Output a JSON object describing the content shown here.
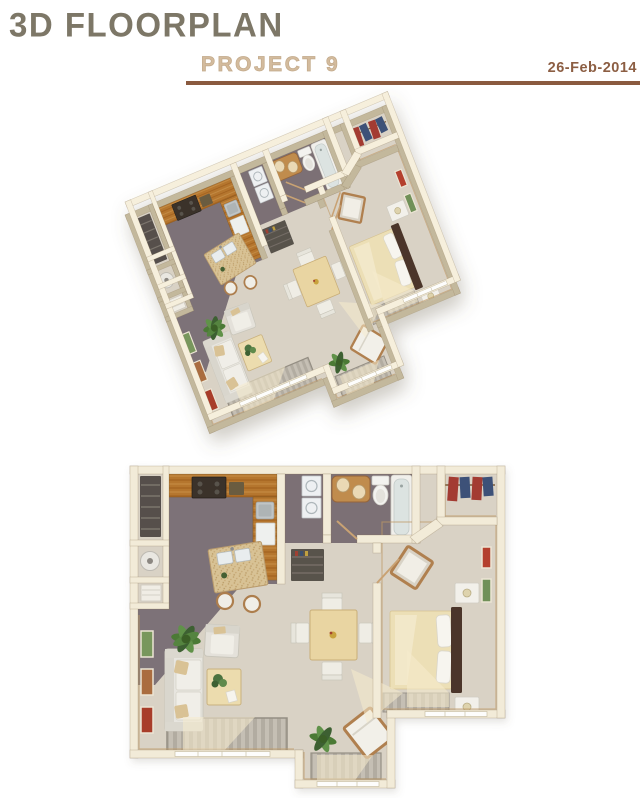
{
  "header": {
    "title": "3D FLOORPLAN",
    "subtitle": "PROJECT 9",
    "date": "26-Feb-2014"
  },
  "views": [
    {
      "id": "perspective",
      "label": "3D perspective render of one-bedroom apartment"
    },
    {
      "id": "top-down",
      "label": "Top-down render of the same one-bedroom apartment"
    }
  ],
  "apartment": {
    "rooms": [
      "kitchen",
      "entry-hall",
      "utility-closet",
      "laundry-nook",
      "bathroom",
      "walk-in-closet",
      "bedroom",
      "dining-area",
      "living-room",
      "balcony-nook"
    ],
    "furniture": [
      "l-shaped-wood-counter",
      "stove",
      "kitchen-island-with-sink",
      "bar-stools",
      "washer-dryer-stack",
      "water-heater",
      "wire-shelving",
      "wood-vanity",
      "toilet",
      "bathtub",
      "hanging-clothes",
      "bed",
      "headboard",
      "nightstands",
      "desk-chair",
      "dining-table",
      "dining-chairs",
      "sofa",
      "armchair",
      "coffee-table",
      "lounge-chair",
      "potted-plants",
      "area-rugs",
      "framed-pictures"
    ]
  },
  "palette": {
    "title_text": "#7d7767",
    "subtitle_text": "#d3bb9d",
    "date_text": "#8c5e43",
    "rule": "#8a5a3f",
    "wall": "#f2ebd8",
    "wall_top": "#f6efdc",
    "wall_shadow": "#c3b89c",
    "floor_light": "#d9d2c5",
    "floor_gray": "#7d7278",
    "wood": "#b5762f",
    "island": "#d8c295",
    "bed": "#ecdfb6",
    "headboard": "#4b3629",
    "greenery": "#48742f",
    "cloth_red": "#a33a31",
    "cloth_blue": "#3c5178"
  }
}
